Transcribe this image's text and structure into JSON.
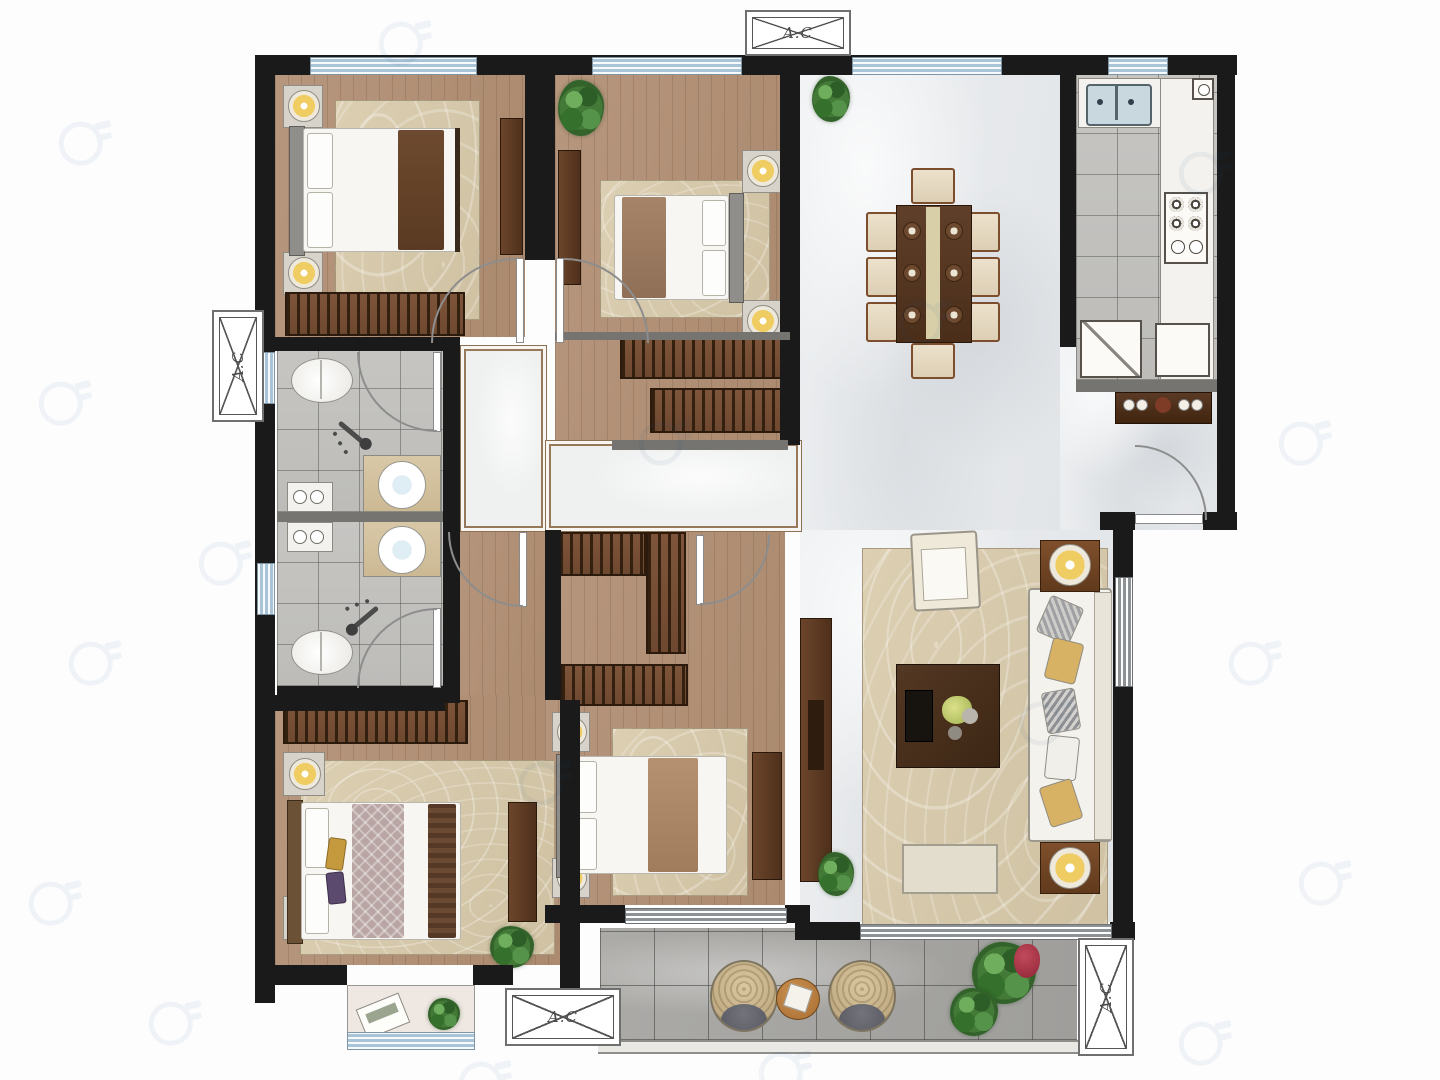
{
  "labels": {
    "ac": "A.C"
  },
  "palette": {
    "wall": "#1a1a1a",
    "wood_floor": "#b3927a",
    "marble_floor": "#eaecee",
    "bathroom_tile": "#c3c2c0",
    "balcony_tile": "#a7a7a5",
    "window_glass": "#a9c4d6",
    "wardrobe": "#7b5236",
    "dark_furniture": "#53351f",
    "rug": "#d6c7a8",
    "lamp": "#f0cd62",
    "plant": "#447a38",
    "sofa": "#f4f2ec"
  },
  "icons": {
    "ac_box": "rectangle-with-diagonal-cross",
    "door": "quarter-circle-arc",
    "window": "striped-band",
    "shower_head": "sprayer-with-dots",
    "watermark": "ring-logo"
  }
}
